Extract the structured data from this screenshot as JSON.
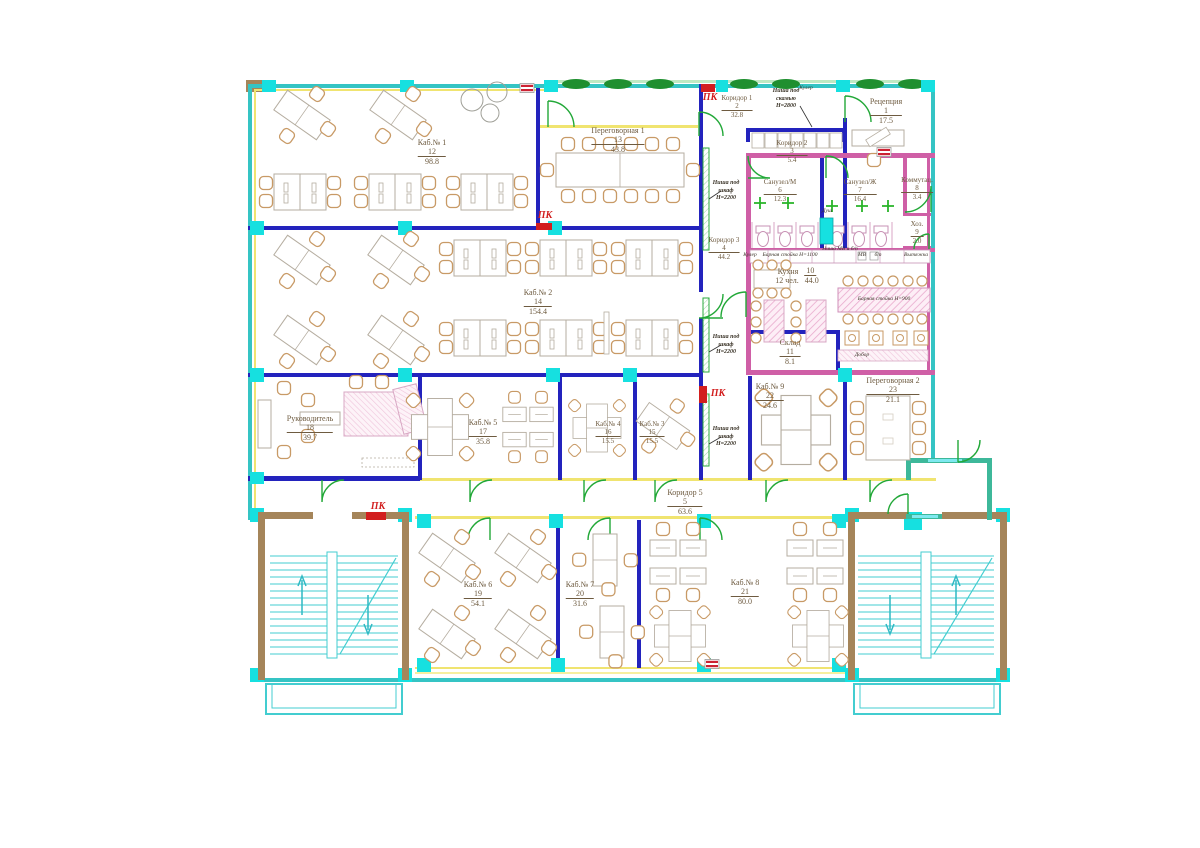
{
  "plan": {
    "rooms": [
      {
        "name": "Рецепция",
        "num": "1",
        "area": "17.5"
      },
      {
        "name": "Коридор 1",
        "num": "2",
        "area": "32.8"
      },
      {
        "name": "Коридор 2",
        "num": "3",
        "area": "5.4"
      },
      {
        "name": "Коридор 3",
        "num": "4",
        "area": "44.2"
      },
      {
        "name": "Коридор 5",
        "num": "5",
        "area": "63.6"
      },
      {
        "name": "Санузел/М",
        "num": "6",
        "area": "12.3"
      },
      {
        "name": "Санузел/Ж",
        "num": "7",
        "area": "16.4"
      },
      {
        "name": "Коммутац.",
        "num": "8",
        "area": "3.4"
      },
      {
        "name": "Хоз.",
        "num": "9",
        "area": "2.0"
      },
      {
        "name": "Кухня",
        "num": "10",
        "area": "44.0",
        "capacity": "12 чел."
      },
      {
        "name": "Склад",
        "num": "11",
        "area": "8.1"
      },
      {
        "name": "Каб.№ 1",
        "num": "12",
        "area": "98.8"
      },
      {
        "name": "Переговорная 1",
        "num": "13",
        "area": "43.8"
      },
      {
        "name": "Каб.№ 2",
        "num": "14",
        "area": "154.4"
      },
      {
        "name": "Каб.№ 3",
        "num": "15",
        "area": "15.5"
      },
      {
        "name": "Каб.№ 4",
        "num": "16",
        "area": "15.5"
      },
      {
        "name": "Каб.№ 5",
        "num": "17",
        "area": "35.8"
      },
      {
        "name": "Руководитель",
        "num": "18",
        "area": "39.7"
      },
      {
        "name": "Каб.№ 6",
        "num": "19",
        "area": "54.1"
      },
      {
        "name": "Каб.№ 7",
        "num": "20",
        "area": "31.6"
      },
      {
        "name": "Каб.№ 8",
        "num": "21",
        "area": "80.0"
      },
      {
        "name": "Каб.№ 9",
        "num": "22",
        "area": "24.6"
      },
      {
        "name": "Переговорная 2",
        "num": "23",
        "area": "21.1"
      }
    ],
    "annotations": {
      "pk": "ПК",
      "nisha_skamya_l1": "Ниша под",
      "nisha_skamya_l2": "скамью",
      "nisha_skamya_l3": "Н=2800",
      "nisha_shkaf_l1": "Ниша под",
      "nisha_shkaf_l2": "шкаф",
      "nisha_shkaf_l3": "Н=2200",
      "kuler": "Кулер",
      "bar_stoyka_1100": "Барная стойка Н=1100",
      "nisha_mv": "Ниша МВ и б/п",
      "mv": "МВ",
      "bp": "б/п",
      "vytyazhka": "Вытяжка",
      "bar_stoyka_900": "Барная стойка Н=900",
      "dobor": "Добор",
      "dush": "Душ"
    },
    "colors": {
      "exterior_wall": "#35c4c4",
      "partition_wall": "#2323bd",
      "wet_zone_wall": "#cf5fa6",
      "column": "#16e0e0",
      "door": "#22a838",
      "fire_cabinet": "#d21f1f",
      "finish_line": "#f0e470",
      "stair_wall": "#a5855a",
      "hedge": "#1f8f2f"
    }
  }
}
